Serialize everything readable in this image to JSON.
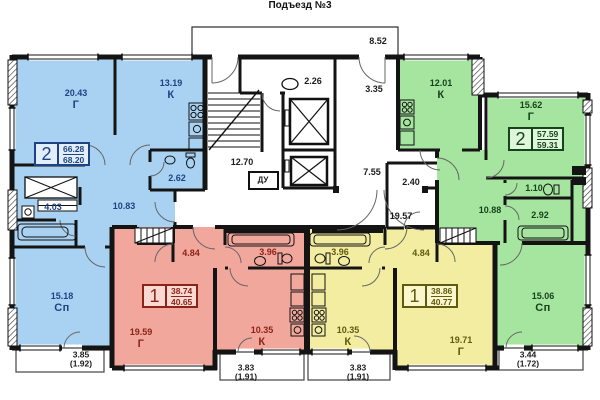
{
  "title": "Подъезд №3",
  "colors": {
    "blue_fill": "#a9d2f2",
    "blue_text": "#1d4383",
    "red_fill": "#f2a79d",
    "red_text": "#8a241a",
    "yellow_fill": "#f3eda1",
    "yellow_text": "#5f5a0e",
    "green_fill": "#a5e5a0",
    "green_text": "#17431a",
    "wall": "#141414"
  },
  "apartments": {
    "blue": {
      "type": "2",
      "area_total": "66.28",
      "area_with_balcony": "68.20",
      "rooms": {
        "living": {
          "area": "20.43",
          "tag": "Г"
        },
        "kitchen": {
          "area": "13.19",
          "tag": "К"
        },
        "bathroom": {
          "area": "2.62"
        },
        "hall": {
          "area": "4.03"
        },
        "corridor": {
          "area": "10.83"
        },
        "bedroom": {
          "area": "15.18",
          "tag": "Сп"
        }
      },
      "balcony": {
        "area": "3.85",
        "reduced": "(1.92)"
      }
    },
    "red": {
      "type": "1",
      "area_total": "38.74",
      "area_with_balcony": "40.65",
      "rooms": {
        "hall": {
          "area": "4.84"
        },
        "bathroom": {
          "area": "3.96"
        },
        "kitchen": {
          "area": "10.35",
          "tag": "К"
        },
        "living": {
          "area": "19.59",
          "tag": "Г"
        }
      },
      "balcony": {
        "area": "3.83",
        "reduced": "(1.91)"
      }
    },
    "yellow": {
      "type": "1",
      "area_total": "38.86",
      "area_with_balcony": "40.77",
      "rooms": {
        "hall": {
          "area": "4.84"
        },
        "bathroom": {
          "area": "3.96"
        },
        "kitchen": {
          "area": "10.35",
          "tag": "К"
        },
        "living": {
          "area": "19.71",
          "tag": "Г"
        }
      },
      "balcony": {
        "area": "3.83",
        "reduced": "(1.91)"
      }
    },
    "green": {
      "type": "2",
      "area_total": "57.59",
      "area_with_balcony": "59.31",
      "rooms": {
        "kitchen": {
          "area": "12.01",
          "tag": "К"
        },
        "living": {
          "area": "15.62",
          "tag": "Г"
        },
        "wc": {
          "area": "1.10"
        },
        "bathroom": {
          "area": "2.92"
        },
        "corridor": {
          "area": "10.88"
        },
        "bedroom": {
          "area": "15.06",
          "tag": "Сп"
        }
      },
      "balcony": {
        "area": "3.44",
        "reduced": "(1.72)"
      }
    }
  },
  "common_areas": {
    "entrance_porch": "8.52",
    "refuse_room": "2.26",
    "stairwell": "12.70",
    "smoke_duct": "ДУ",
    "lobby_upper": "3.35",
    "lobby_mid": "7.55",
    "storage": "2.40",
    "corridor": "19.57"
  }
}
